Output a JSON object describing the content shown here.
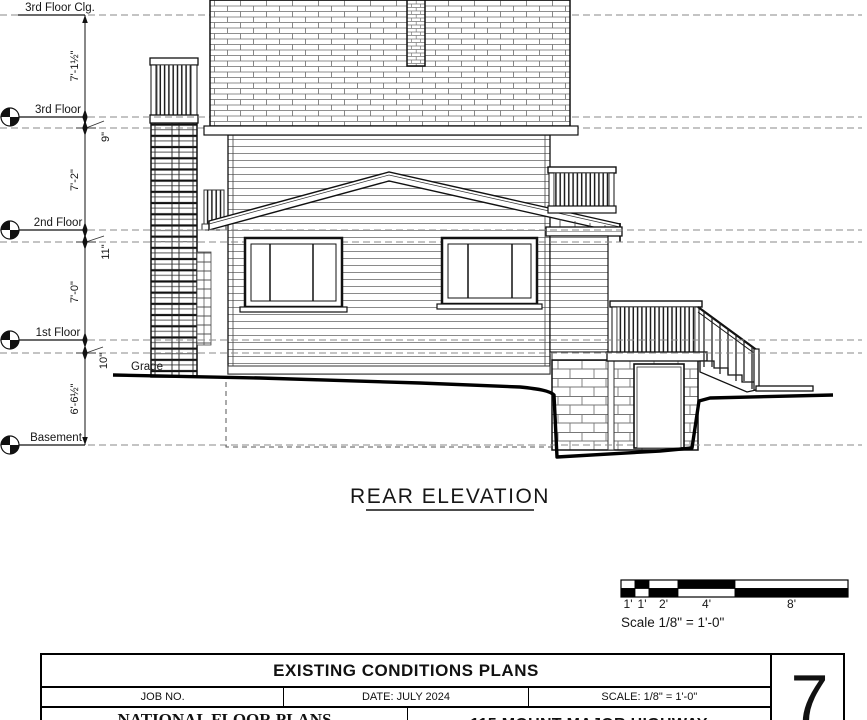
{
  "drawing": {
    "title": "REAR ELEVATION",
    "levels": {
      "third_floor_clg": "3rd Floor Clg.",
      "third_floor": "3rd Floor",
      "second_floor": "2nd Floor",
      "first_floor": "1st Floor",
      "basement": "Basement",
      "grade": "Grade"
    },
    "dimensions": {
      "clg_to_3rd": "7'-1½\"",
      "joist_3rd": "9\"",
      "third_to_2nd": "7'-2\"",
      "joist_2nd": "11\"",
      "second_to_1st": "7'-0\"",
      "joist_1st": "10\"",
      "first_to_basement": "6'-6½\""
    },
    "colors": {
      "line": "#111111",
      "background": "#ffffff"
    }
  },
  "scale_bar": {
    "ticks": [
      "1'",
      "1'",
      "2'",
      "4'",
      "8'"
    ],
    "caption": "Scale  1/8\" = 1'-0\""
  },
  "title_block": {
    "title": "EXISTING CONDITIONS PLANS",
    "job_no_label": "JOB NO.",
    "date": "DATE: JULY 2024",
    "scale": "SCALE: 1/8\" = 1'-0\"",
    "company": "NATIONAL FLOOR PLANS",
    "address": "115 MOUNT MAJOR HIGHWAY",
    "sheet_number": "7"
  }
}
